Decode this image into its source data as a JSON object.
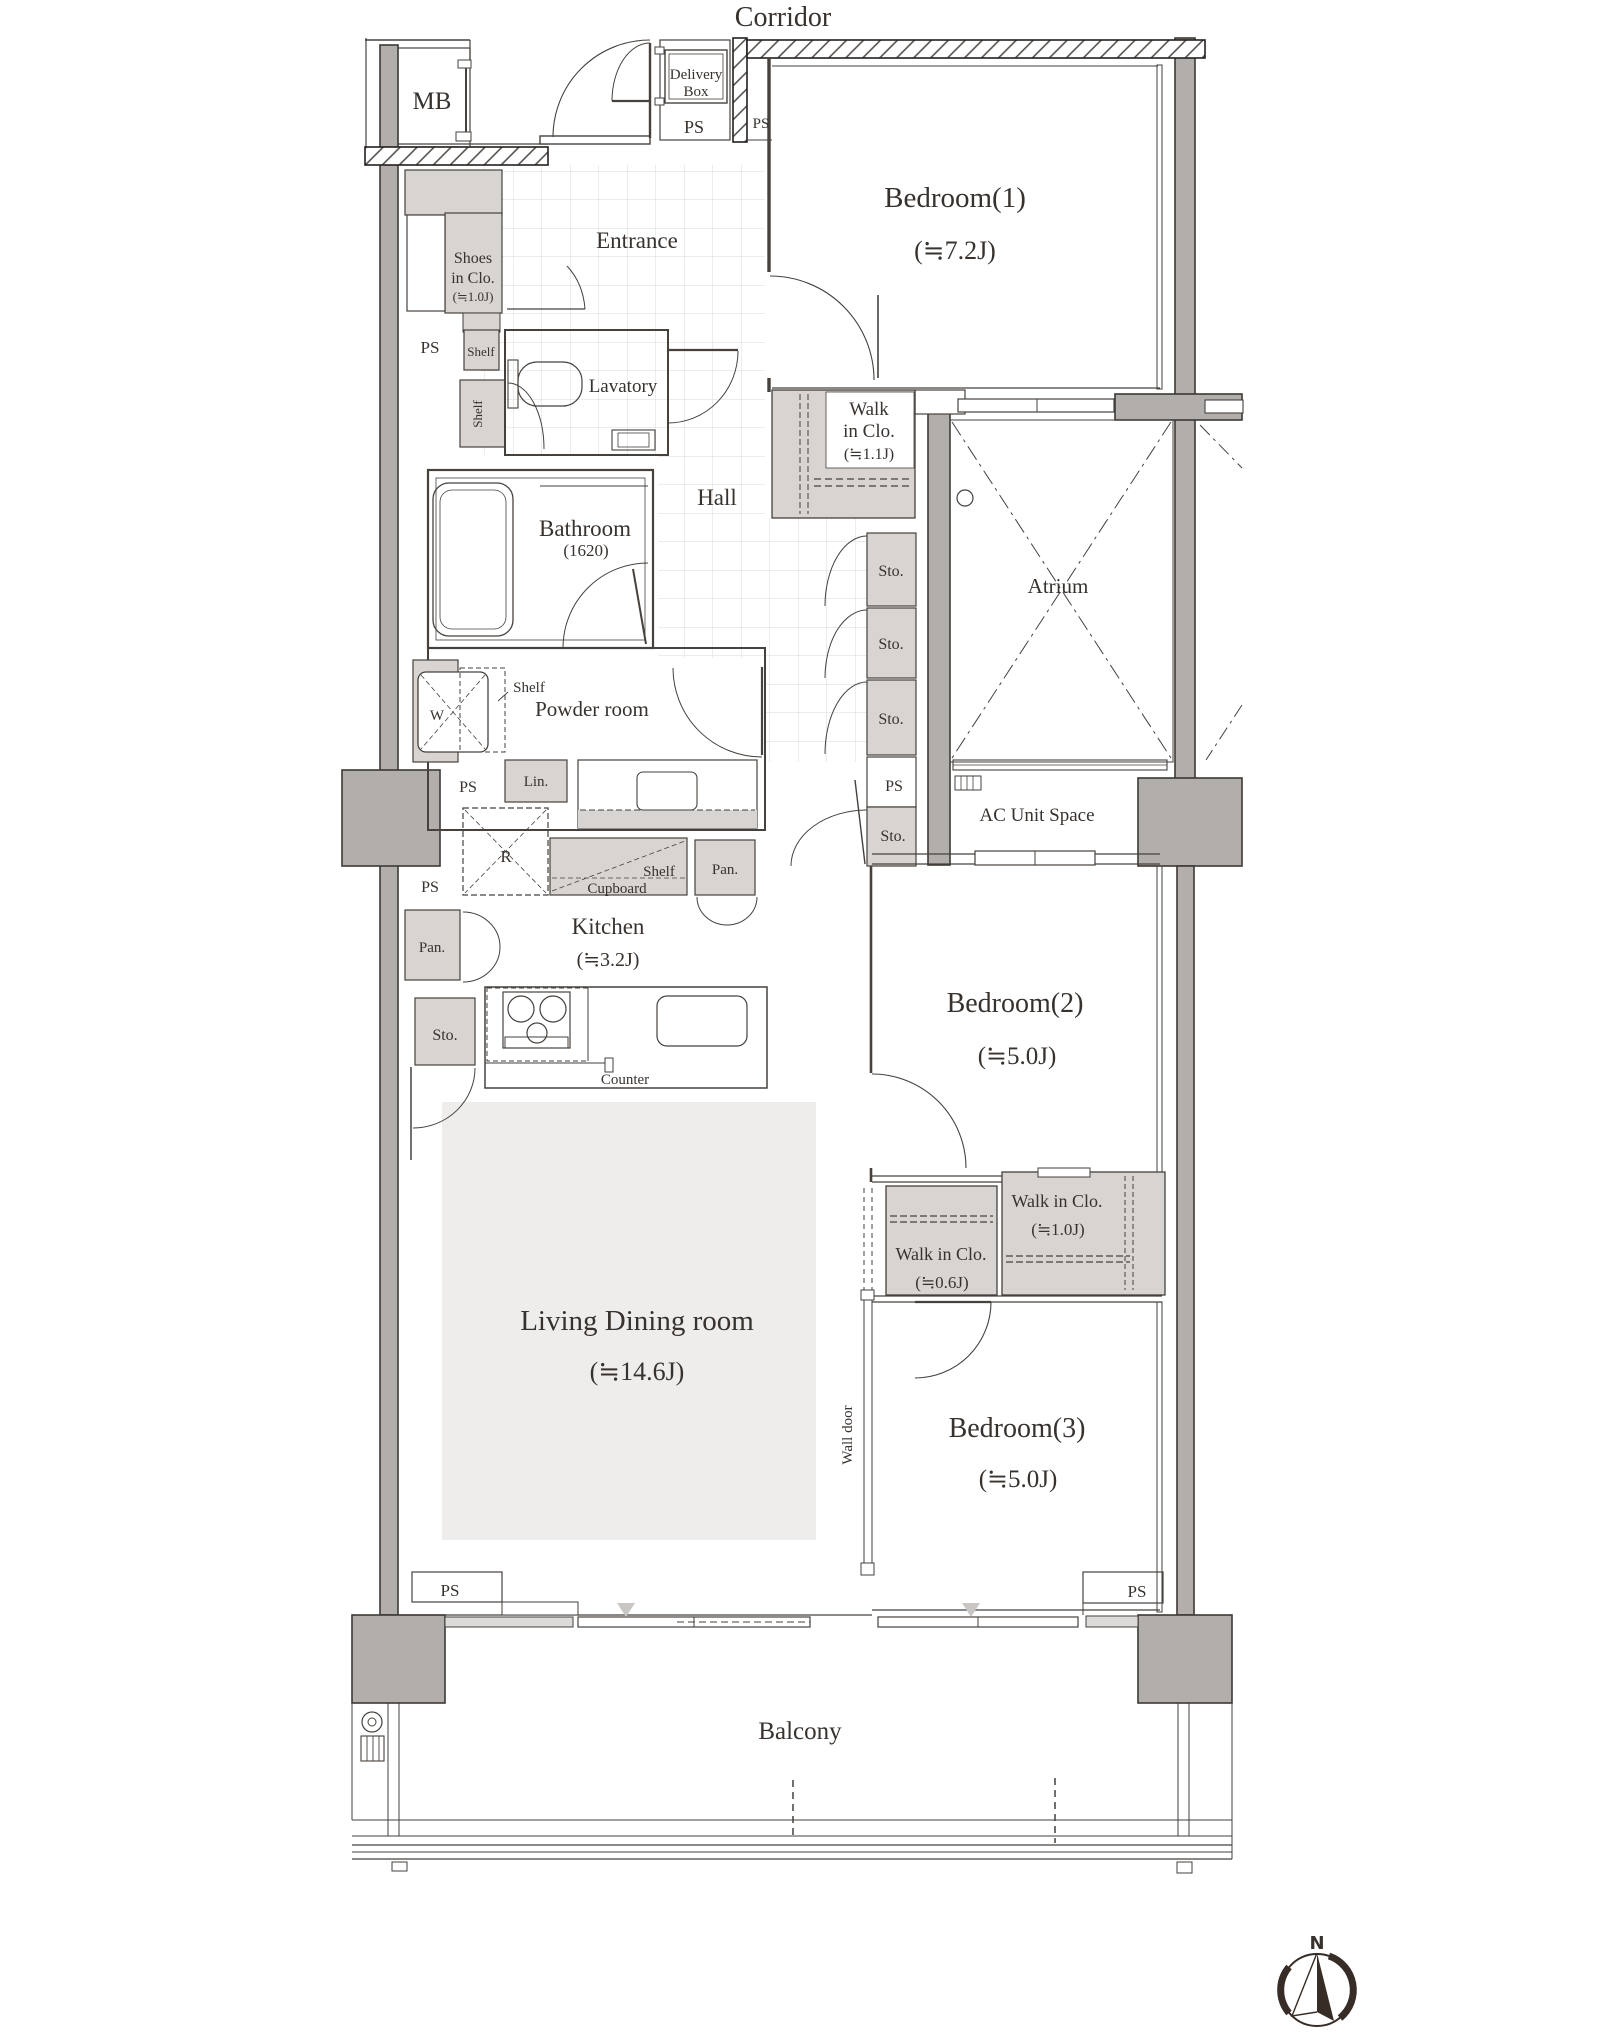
{
  "plan_title": "3LDK apartment floor plan",
  "labels": {
    "corridor": "Corridor",
    "mb": "MB",
    "delivery_line1": "Delivery",
    "delivery_line2": "Box",
    "ps": "PS",
    "entrance": "Entrance",
    "shoes_line1": "Shoes",
    "shoes_line2": "in Clo.",
    "shoes_line3": "(≒1.0J)",
    "shelf": "Shelf",
    "lavatory": "Lavatory",
    "hall": "Hall",
    "bathroom": "Bathroom",
    "bathroom_size": "(1620)",
    "powder_room": "Powder room",
    "washing_machine": "W",
    "linen": "Lin.",
    "storage": "Sto.",
    "atrium": "Atrium",
    "ac_unit_space": "AC Unit Space",
    "refrigerator": "R",
    "cupboard": "Cupboard",
    "pantry": "Pan.",
    "kitchen": "Kitchen",
    "kitchen_size": "(≒3.2J)",
    "counter": "Counter",
    "living_dining": "Living Dining room",
    "living_dining_size": "(≒14.6J)",
    "wall_door": "Wall door",
    "balcony": "Balcony",
    "north": "N"
  },
  "rooms": {
    "bedroom1": {
      "name": "Bedroom(1)",
      "size": "(≒7.2J)"
    },
    "bedroom2": {
      "name": "Bedroom(2)",
      "size": "(≒5.0J)"
    },
    "bedroom3": {
      "name": "Bedroom(3)",
      "size": "(≒5.0J)"
    },
    "wic11": {
      "line1": "Walk",
      "line2": "in Clo.",
      "line3": "(≒1.1J)"
    },
    "wic10": {
      "name": "Walk in Clo.",
      "size": "(≒1.0J)"
    },
    "wic06": {
      "name": "Walk in Clo.",
      "size": "(≒0.6J)"
    }
  },
  "colors": {
    "wall_fill": "#b1aeac",
    "closet_fill": "#d8d4d1",
    "rug_fill": "#efedeb",
    "glazing_fill": "#dddbd9",
    "line": "#46413d",
    "text": "#38322e",
    "compass": "#372c26"
  }
}
